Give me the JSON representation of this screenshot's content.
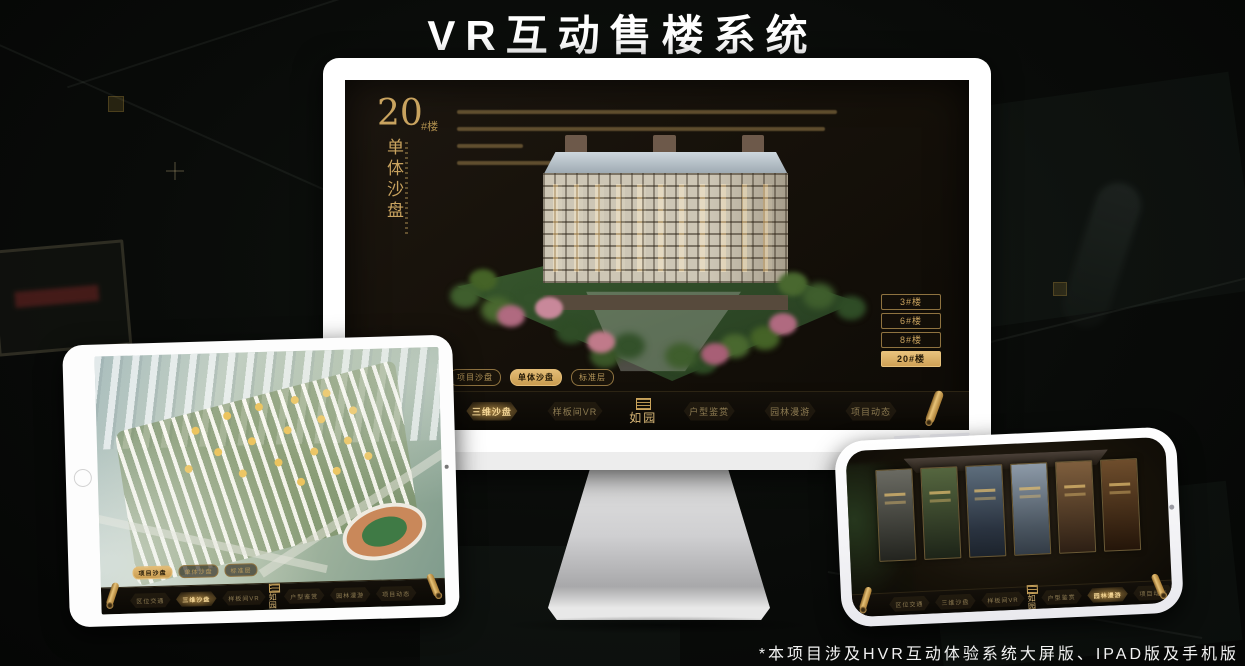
{
  "header": {
    "title": "VR互动售楼系统"
  },
  "footer": {
    "note": "*本项目涉及HVR互动体验系统大屏版、IPAD版及手机版"
  },
  "colors": {
    "gold": "#c9a35f",
    "gold_active": "#e3bc76",
    "screen_bg": "#16110a",
    "nav_bg": "#0a0804"
  },
  "monitor": {
    "heading": {
      "number": "20",
      "suffix": "#楼",
      "title": "单体沙盘"
    },
    "floor_buttons": [
      {
        "label": "3#楼",
        "active": false
      },
      {
        "label": "6#楼",
        "active": false
      },
      {
        "label": "8#楼",
        "active": false
      },
      {
        "label": "20#楼",
        "active": true
      }
    ],
    "sub_tabs": [
      {
        "label": "项目沙盘",
        "active": false
      },
      {
        "label": "单体沙盘",
        "active": true
      },
      {
        "label": "标准层",
        "active": false
      }
    ],
    "nav": {
      "left_items": [
        {
          "label": "区位交通",
          "active": false
        },
        {
          "label": "三维沙盘",
          "active": true
        },
        {
          "label": "样板间VR",
          "active": false
        }
      ],
      "logo_label": "如园",
      "right_items": [
        {
          "label": "户型鉴赏",
          "active": false
        },
        {
          "label": "园林漫游",
          "active": false
        },
        {
          "label": "项目动态",
          "active": false
        }
      ]
    }
  },
  "tablet": {
    "sub_tabs": [
      {
        "label": "项目沙盘",
        "active": true
      },
      {
        "label": "单体沙盘",
        "active": false
      },
      {
        "label": "标准层",
        "active": false
      }
    ],
    "nav": {
      "left_items": [
        {
          "label": "区位交通",
          "active": false
        },
        {
          "label": "三维沙盘",
          "active": true
        },
        {
          "label": "样板间VR",
          "active": false
        }
      ],
      "logo_label": "如园",
      "right_items": [
        {
          "label": "户型鉴赏",
          "active": false
        },
        {
          "label": "园林漫游",
          "active": false
        },
        {
          "label": "项目动态",
          "active": false
        }
      ]
    }
  },
  "phone": {
    "nav": {
      "left_items": [
        {
          "label": "区位交通",
          "active": false
        },
        {
          "label": "三维沙盘",
          "active": false
        },
        {
          "label": "样板间VR",
          "active": false
        }
      ],
      "logo_label": "如园",
      "right_items": [
        {
          "label": "户型鉴赏",
          "active": false
        },
        {
          "label": "园林漫游",
          "active": true
        },
        {
          "label": "项目动态",
          "active": false
        }
      ]
    }
  }
}
